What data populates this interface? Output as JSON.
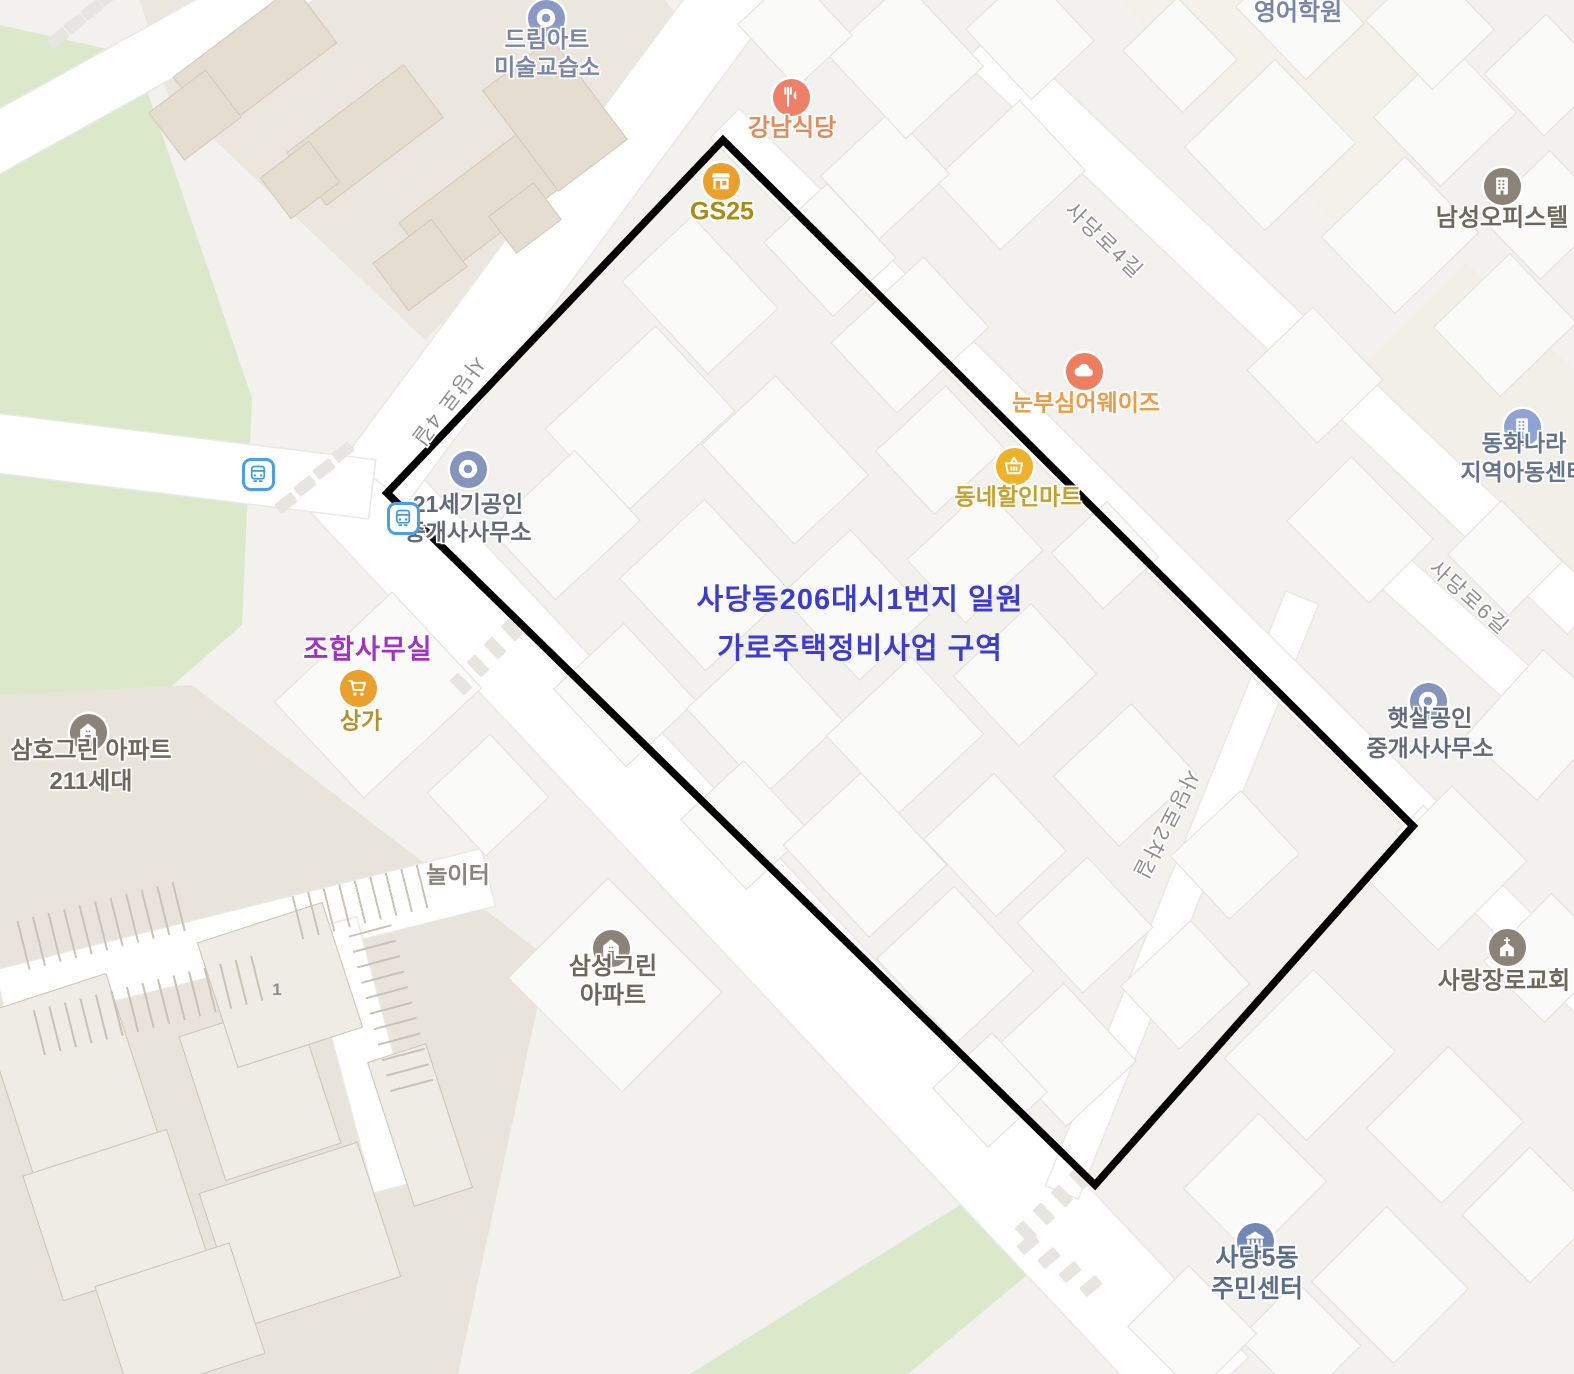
{
  "region": {
    "annotation_line1": "사당동206대시1번지 일원",
    "annotation_line2": "가로주택정비사업 구역",
    "annotation_color": "#3d3cd0",
    "outline_points": "723,140 1413,826 1095,1185 387,493",
    "outline_color": "#000000"
  },
  "labels": {
    "union_office": "조합사무실",
    "union_office_color": "#a132c2",
    "building_number": "1"
  },
  "pois": [
    {
      "id": "dream-art-academy",
      "lines": [
        "드림아트",
        "미술교습소"
      ],
      "icon": "donut",
      "icon_color": "#8a99c4",
      "text_color": "#7b86a6",
      "icon_x": 546,
      "icon_y": 18,
      "label_x": 547,
      "label_y": 53,
      "lh": 28,
      "size": 23
    },
    {
      "id": "gangnam-restaurant",
      "lines": [
        "강남식당"
      ],
      "icon": "restaurant",
      "icon_color": "#ed8066",
      "text_color": "#e58a5a",
      "icon_x": 791,
      "icon_y": 97,
      "label_x": 792,
      "label_y": 128,
      "lh": 29,
      "size": 24
    },
    {
      "id": "gs25",
      "lines": [
        "GS25"
      ],
      "icon": "storefront",
      "icon_color": "#eba02c",
      "text_color": "#a88b10",
      "icon_x": 721,
      "icon_y": 181,
      "label_x": 722,
      "label_y": 212,
      "lh": 29,
      "size": 25
    },
    {
      "id": "english-academy",
      "lines": [
        "어림아이",
        "영어학원"
      ],
      "icon": null,
      "icon_color": null,
      "text_color": "#7b86a6",
      "icon_x": null,
      "icon_y": null,
      "label_x": 1298,
      "label_y": -2,
      "lh": 30,
      "size": 24
    },
    {
      "id": "namseong-officetel",
      "lines": [
        "남성오피스텔"
      ],
      "icon": "building",
      "icon_color": "#8b8378",
      "text_color": "#6e675c",
      "icon_x": 1502,
      "icon_y": 186,
      "label_x": 1502,
      "label_y": 218,
      "lh": 29,
      "size": 24
    },
    {
      "id": "nunbusim-aways",
      "lines": [
        "눈부심어웨이즈"
      ],
      "icon": "cloud",
      "icon_color": "#ed7e5f",
      "text_color": "#ef9a45",
      "icon_x": 1084,
      "icon_y": 371,
      "label_x": 1086,
      "label_y": 403,
      "lh": 29,
      "size": 23
    },
    {
      "id": "dongne-discount-mart",
      "lines": [
        "동네할인마트"
      ],
      "icon": "basket",
      "icon_color": "#ecb32a",
      "text_color": "#c3a12b",
      "icon_x": 1014,
      "icon_y": 466,
      "label_x": 1018,
      "label_y": 497,
      "lh": 29,
      "size": 23
    },
    {
      "id": "c21-realty",
      "lines": [
        "21세기공인",
        "중개사사무소"
      ],
      "icon": "donut",
      "icon_color": "#8494bd",
      "text_color": "#62697a",
      "icon_x": 468,
      "icon_y": 469,
      "label_x": 468,
      "label_y": 518,
      "lh": 28,
      "size": 23
    },
    {
      "id": "donghwa-childrens-center",
      "lines": [
        "동화나라",
        "지역아동센터"
      ],
      "icon": "building",
      "icon_color": "#8ea3d4",
      "text_color": "#68748e",
      "icon_x": 1522,
      "icon_y": 427,
      "label_x": 1524,
      "label_y": 458,
      "lh": 29,
      "size": 23
    },
    {
      "id": "sangga-shop",
      "lines": [
        "상가"
      ],
      "icon": "cart",
      "icon_color": "#eba02c",
      "text_color": "#b3922a",
      "icon_x": 358,
      "icon_y": 688,
      "label_x": 361,
      "label_y": 721,
      "lh": 29,
      "size": 23
    },
    {
      "id": "samho-green-apt",
      "lines": [
        "삼호그린 아파트",
        "211세대"
      ],
      "icon": "house",
      "icon_color": "#8b8378",
      "text_color": "#6e675c",
      "icon_x": 88,
      "icon_y": 732,
      "label_x": 91,
      "label_y": 766,
      "lh": 31,
      "size": 24
    },
    {
      "id": "haessal-realty",
      "lines": [
        "햇살공인",
        "중개사사무소"
      ],
      "icon": "donut",
      "icon_color": "#8494bd",
      "text_color": "#62697a",
      "icon_x": 1428,
      "icon_y": 701,
      "label_x": 1430,
      "label_y": 733,
      "lh": 30,
      "size": 23
    },
    {
      "id": "playground",
      "lines": [
        "놀이터"
      ],
      "icon": null,
      "icon_color": null,
      "text_color": "#8a857c",
      "icon_x": null,
      "icon_y": null,
      "label_x": 458,
      "label_y": 875,
      "lh": 29,
      "size": 23
    },
    {
      "id": "samsung-green-apt",
      "lines": [
        "삼성그린",
        "아파트"
      ],
      "icon": "house",
      "icon_color": "#8b8378",
      "text_color": "#6e675c",
      "icon_x": 611,
      "icon_y": 948,
      "label_x": 613,
      "label_y": 981,
      "lh": 29,
      "size": 24
    },
    {
      "id": "sarang-church",
      "lines": [
        "사랑장로교회"
      ],
      "icon": "church",
      "icon_color": "#8b8378",
      "text_color": "#6e675c",
      "icon_x": 1507,
      "icon_y": 947,
      "label_x": 1504,
      "label_y": 981,
      "lh": 29,
      "size": 24
    },
    {
      "id": "sadang5-community-center",
      "lines": [
        "사당5동",
        "주민센터"
      ],
      "icon": "government",
      "icon_color": "#7289b7",
      "text_color": "#5d6d8c",
      "icon_x": 1255,
      "icon_y": 1241,
      "label_x": 1257,
      "label_y": 1274,
      "lh": 31,
      "size": 25
    }
  ],
  "street_labels": [
    {
      "label": "사당로 4길",
      "x": 449,
      "y": 402,
      "angle": 127
    },
    {
      "label": "사당로4길",
      "x": 1105,
      "y": 240,
      "angle": 44
    },
    {
      "label": "사당로6길",
      "x": 1470,
      "y": 597,
      "angle": 42
    },
    {
      "label": "사당로2차길",
      "x": 1167,
      "y": 825,
      "angle": 117
    }
  ],
  "bus_stops": [
    {
      "x": 258,
      "y": 474
    },
    {
      "x": 403,
      "y": 518
    }
  ],
  "colors": {
    "park_green": "#dce8ca",
    "road": "#ffffff",
    "background": "#f2f1ee",
    "block_tan": "#ebe7df",
    "parking_beige": "#e8e4dc"
  }
}
